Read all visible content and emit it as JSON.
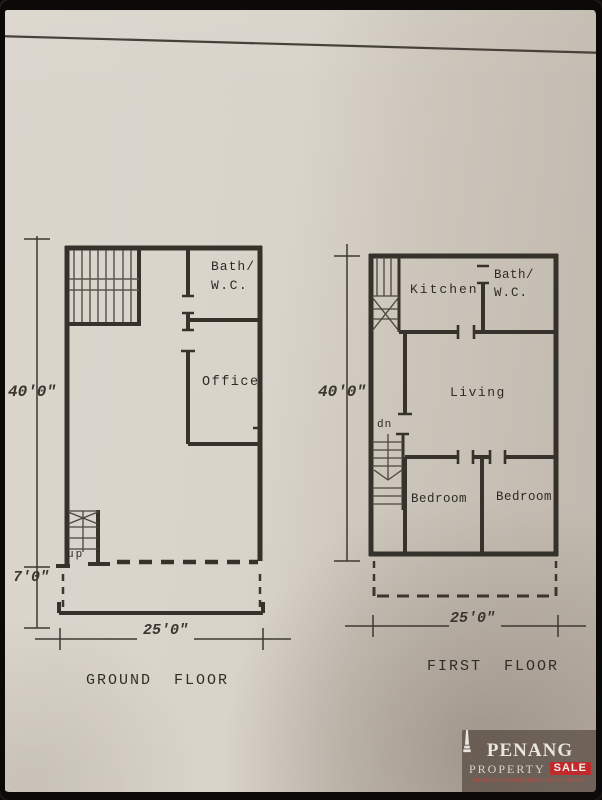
{
  "photo": {
    "paper_color": "#d9d4ca",
    "frame_color": "#0b0a09",
    "ink_color": "#37332c"
  },
  "ground_floor": {
    "title": "GROUND  FLOOR",
    "labels": {
      "bath_line1": "Bath/",
      "bath_line2": "W.C.",
      "office": "Office",
      "stairs": "up"
    },
    "dimensions": {
      "height": "40'0\"",
      "porch_depth": "7'0\"",
      "width": "25'0\""
    }
  },
  "first_floor": {
    "title": "FIRST  FLOOR",
    "labels": {
      "kitchen": "Kitchen",
      "bath_line1": "Bath/",
      "bath_line2": "W.C.",
      "living": "Living",
      "bedroom_left": "Bedroom",
      "bedroom_right": "Bedroom",
      "stairs": "dn"
    },
    "dimensions": {
      "height": "40'0\"",
      "width": "25'0\""
    }
  },
  "watermark": {
    "line1": "PENANG",
    "line2_left": "PROPERTY",
    "line2_right": "SALE",
    "tagline": "PENANG'S #1 PROPERTY MARKETPLACE",
    "sale_color": "#c02a2c"
  }
}
